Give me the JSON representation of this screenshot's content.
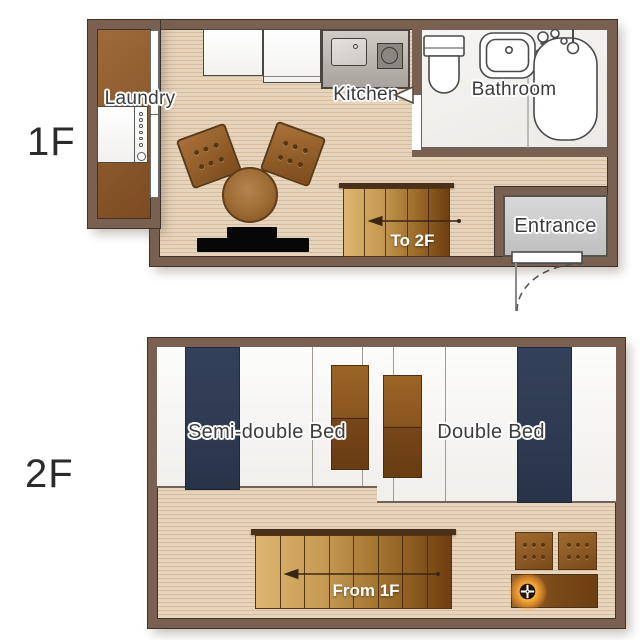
{
  "floor1": {
    "floor_label": "1F",
    "laundry_label": "Laundry",
    "kitchen_label": "Kitchen",
    "bathroom_label": "Bathroom",
    "entrance_label": "Entrance",
    "stairs_label": "To 2F"
  },
  "floor2": {
    "floor_label": "2F",
    "semi_double_bed_label": "Semi-double Bed",
    "double_bed_label": "Double Bed",
    "stairs_label": "From 1F"
  },
  "icons": {
    "washing_machine": "washing-machine-icon",
    "kitchen_sink": "kitchen-sink-icon",
    "stove": "stove-icon",
    "toilet": "toilet-icon",
    "bathroom_sink": "bathroom-sink-icon",
    "bathtub": "bathtub-icon",
    "shower": "shower-icon",
    "door_swing_marker": "door-swing-icon",
    "entrance_door_arc": "door-arc-icon",
    "stairs_arrow": "arrow-icon",
    "burner": "burner-icon"
  },
  "colors": {
    "wall": "#796050",
    "wall_outline": "#3e332b",
    "floor_light": "#e7d4bd",
    "floor_dark": "#d6bc9e",
    "laundry_floor": "#8f5c2e",
    "bedding_navy": "#2e3b52",
    "furniture_brown": "#8a5a26",
    "stair_light": "#ddb670",
    "stair_dark": "#6e3e10",
    "entrance_gray": "#cccccc",
    "tv_black": "#0a0a0a",
    "lamp_glow": "#ff9d2e"
  }
}
